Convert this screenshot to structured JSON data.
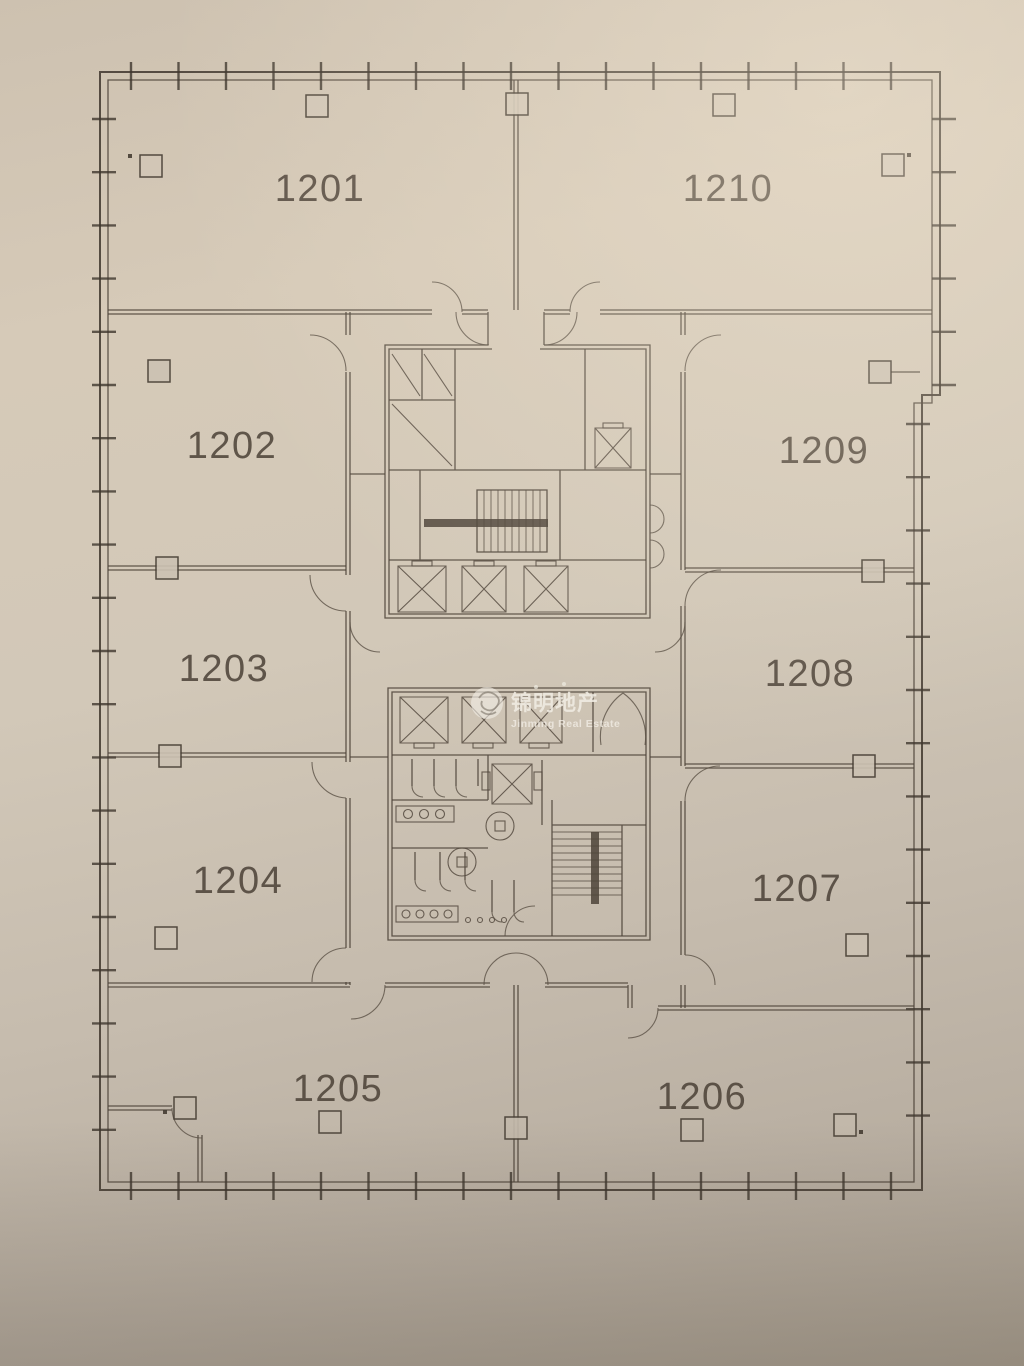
{
  "watermark": {
    "name_zh": "锦明地产",
    "name_en": "Jinming Real Estate"
  },
  "rooms": [
    {
      "label": "1201"
    },
    {
      "label": "1202"
    },
    {
      "label": "1203"
    },
    {
      "label": "1204"
    },
    {
      "label": "1205"
    },
    {
      "label": "1206"
    },
    {
      "label": "1207"
    },
    {
      "label": "1208"
    },
    {
      "label": "1209"
    },
    {
      "label": "1210"
    }
  ],
  "colors": {
    "paper_light": "#d6cab8",
    "paper": "#ccc2b3",
    "paper_dark": "#aba192",
    "line": "#4e443a",
    "watermark": "#f0ece3"
  }
}
